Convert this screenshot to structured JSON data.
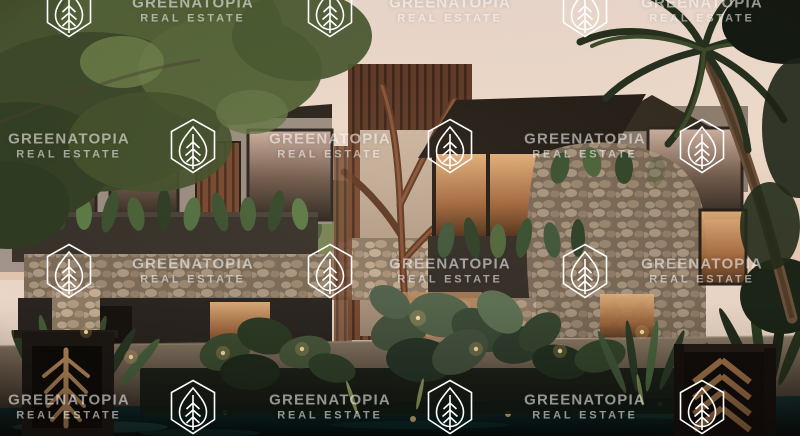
{
  "watermark": {
    "brand": "GREENATOPIA",
    "tagline": "REAL ESTATE",
    "icon": "leaf-shield-icon",
    "text_color": "#ffffff",
    "opacity": 0.55
  },
  "image": {
    "palette": {
      "sky": "#ecd7c6",
      "foliage_dark": "#32402a",
      "foliage_light": "#5d7f49",
      "wood": "#774a31",
      "stone": "#b7a289",
      "charcoal_wall": "#36312c",
      "window_glow": "#d9a05f",
      "water": "#0c2021"
    }
  }
}
